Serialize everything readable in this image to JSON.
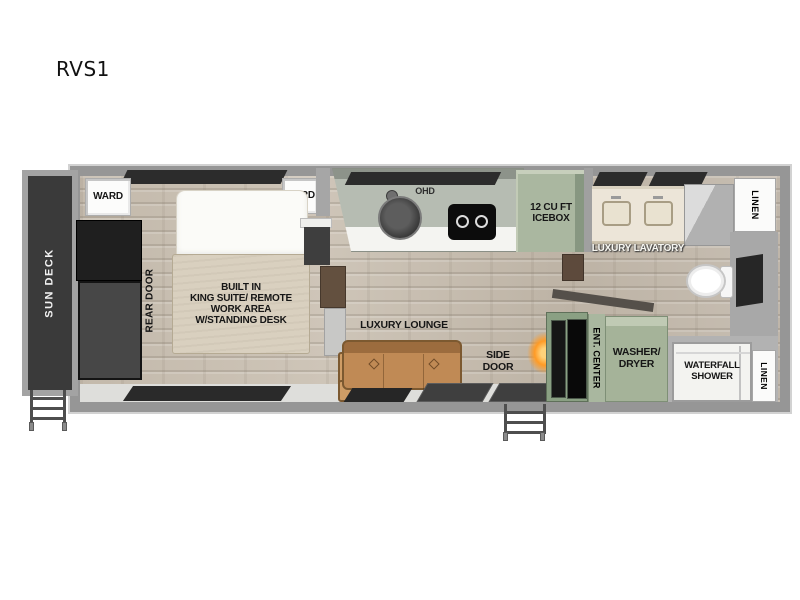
{
  "title": "RVS1",
  "labels": {
    "sun_deck": "SUN DECK",
    "ward_left": "WARD",
    "ward_right": "WARD",
    "rear_door": "REAR DOOR",
    "bed": "BUILT IN\nKING SUITE/ REMOTE\nWORK AREA\nW/STANDING DESK",
    "ohd": "OHD",
    "icebox": "12 CU FT\nICEBOX",
    "luxury_lavatory": "LUXURY LAVATORY",
    "linen_top": "LINEN",
    "luxury_lounge": "LUXURY LOUNGE",
    "side_door": "SIDE\nDOOR",
    "ent_center": "ENT. CENTER",
    "washer_dryer": "WASHER/\nDRYER",
    "waterfall_shower": "WATERFALL\nSHOWER",
    "linen_bottom": "LINEN"
  },
  "colors": {
    "wall_gray": "#969696",
    "deck_dark": "#3a3a3a",
    "wood_floor": "#c6bcae",
    "appliance_green": "#a9b79f",
    "bed_beige": "#d9d0bf",
    "sofa_tan": "#c08a55",
    "cabinet_brown": "#63503f",
    "fire_glow": "#ff9b26"
  }
}
